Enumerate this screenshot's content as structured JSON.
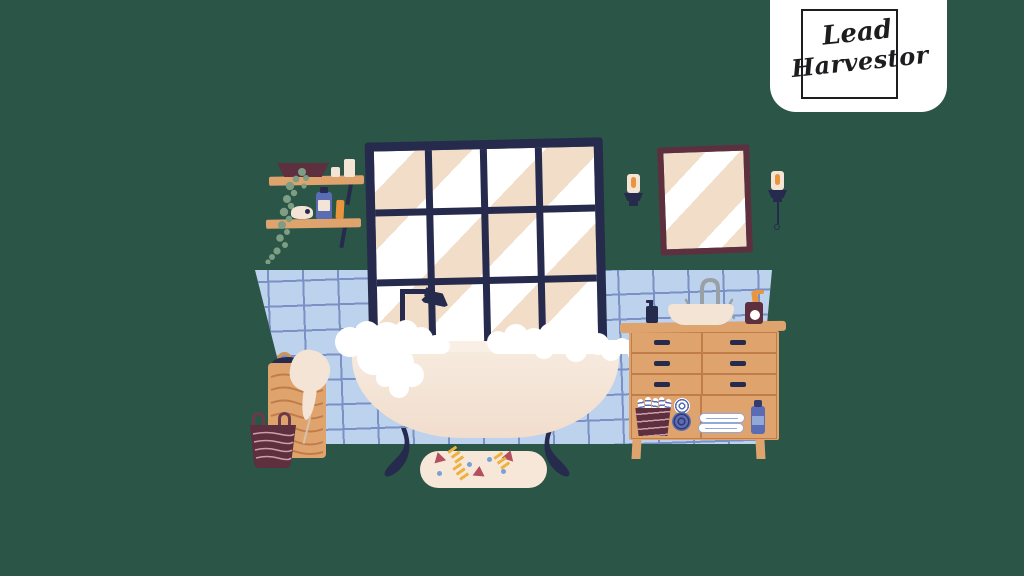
{
  "logo": {
    "line1": "Lead",
    "line2": "Harvestor"
  },
  "palette": {
    "background": "#2b5546",
    "navy": "#262b4d",
    "tile": "#bdd2ec",
    "tile-line": "#7b90c4",
    "wood": "#dfa36d",
    "wood-line": "#c07c49",
    "maroon": "#5e2f3e",
    "maroon-line": "#c9a0a8",
    "cream": "#f4e4d6",
    "cream-dark": "#d9c2ac",
    "beige": "#f1ddc8",
    "orange": "#e9953f",
    "yellow": "#ecb23f",
    "blue": "#5a6cb4",
    "blue-dark": "#333b6e",
    "blue-light": "#93a7d8",
    "plant": "#7d9d85",
    "gray": "#9aa0a8",
    "white": "#ffffff",
    "ink": "#1d1d1f",
    "mat-red": "#b34f5e",
    "dot-blue": "#78a1d6"
  },
  "scene": {
    "items": [
      "wall-tiles",
      "window",
      "shower-head",
      "wall-shelves",
      "hanging-plant",
      "candles",
      "mirror",
      "wall-sconces",
      "clawfoot-bathtub",
      "bath-foam",
      "bath-mat",
      "laundry-baskets",
      "draped-towel",
      "vanity-dresser",
      "sink-bowl",
      "faucet",
      "soap-bottles",
      "rolled-towels",
      "folded-towels"
    ]
  }
}
